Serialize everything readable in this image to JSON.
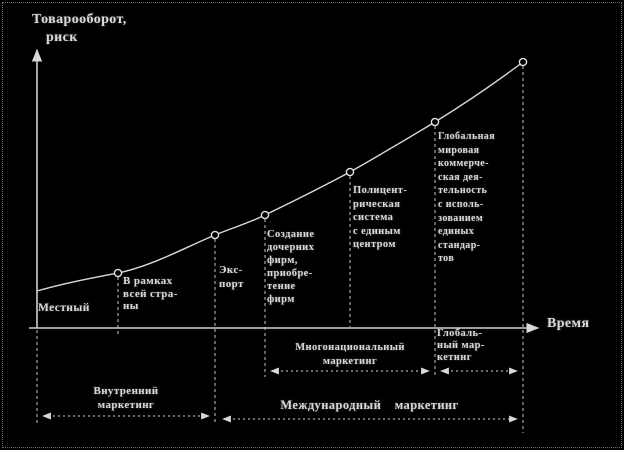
{
  "colors": {
    "background": "#000000",
    "ink": "#d9d9d9"
  },
  "axes": {
    "y_label_line1": "Товарооборот,",
    "y_label_line2": "риск",
    "x_label": "Время"
  },
  "stages": [
    {
      "label": "Местный"
    },
    {
      "label": "В рамках\nвсей стра-\nны"
    },
    {
      "label": "Экс-\nпорт"
    },
    {
      "label": "Создание\nдочерних\nфирм,\nприобре-\nтение\nфирм"
    },
    {
      "label": "Полицент-\nрическая\nсистема\nс единым\nцентром"
    },
    {
      "label": "Глобальная\nмировая\nкоммерче-\nская дея-\nтельность\nс исполь-\nзованием\nединых\nстандар-\nтов"
    }
  ],
  "brackets": {
    "multinational": {
      "label": "Многонациональный\nмаркетинг"
    },
    "global": {
      "label": "Глобаль-\nный мар-\nкетинг"
    },
    "domestic": {
      "label": "Внутренний\nмаркетинг"
    },
    "international": {
      "label": "Международный маркетинг"
    }
  },
  "chart_data": {
    "type": "line",
    "title": "",
    "xlabel": "Время",
    "ylabel": "Товарооборот, риск",
    "grid": false,
    "axis_ticks": "none (qualitative conceptual curve)",
    "curve_shape": "single monotonically increasing convex curve with 6 marked circle points; turnover and risk accelerate over time",
    "points_rel_x": [
      0.0,
      0.17,
      0.37,
      0.47,
      0.64,
      0.82,
      1.0
    ],
    "points_rel_y": [
      0.14,
      0.2,
      0.33,
      0.4,
      0.56,
      0.74,
      0.95
    ],
    "stage_segments": [
      {
        "label": "Местный",
        "x_rel": [
          0.0,
          0.17
        ]
      },
      {
        "label": "В рамках всей страны",
        "x_rel": [
          0.17,
          0.37
        ]
      },
      {
        "label": "Экспорт",
        "x_rel": [
          0.37,
          0.47
        ]
      },
      {
        "label": "Создание дочерних фирм, приобретение фирм",
        "x_rel": [
          0.47,
          0.64
        ]
      },
      {
        "label": "Полицентрическая система с единым центром",
        "x_rel": [
          0.64,
          0.82
        ]
      },
      {
        "label": "Глобальная мировая коммерческая деятельность с использованием единых стандартов",
        "x_rel": [
          0.82,
          1.0
        ]
      }
    ],
    "span_annotations": [
      {
        "label": "Внутренний маркетинг",
        "x_rel": [
          0.0,
          0.37
        ],
        "row": 2
      },
      {
        "label": "Международный маркетинг",
        "x_rel": [
          0.37,
          1.0
        ],
        "row": 2
      },
      {
        "label": "Многонациональный маркетинг",
        "x_rel": [
          0.47,
          0.82
        ],
        "row": 1
      },
      {
        "label": "Глобальный маркетинг",
        "x_rel": [
          0.82,
          1.0
        ],
        "row": 1
      }
    ]
  }
}
